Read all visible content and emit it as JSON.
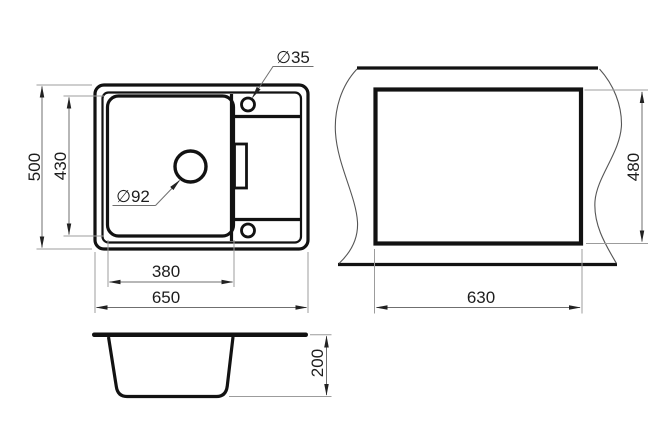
{
  "drawing_type": "sink-dimension-drawing",
  "colors": {
    "background": "#ffffff",
    "object_line": "#121212",
    "dim_line": "#6f6f6f",
    "ext_line": "#9c9c9c",
    "break_line": "#555555",
    "arrow": "#222222",
    "text": "#1d1d1d"
  },
  "labels": {
    "top_overall_width": "650",
    "top_overall_depth": "500",
    "top_bowl_width": "380",
    "top_bowl_depth": "430",
    "top_drain_diameter": "∅92",
    "top_tap_hole_diameter": "∅35",
    "cutout_width": "630",
    "cutout_height": "480",
    "front_bowl_depth": "200"
  }
}
